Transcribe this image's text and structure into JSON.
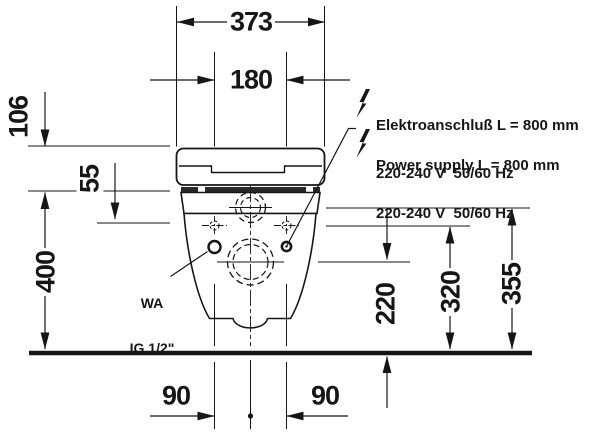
{
  "dimensions": {
    "d373": "373",
    "d180": "180",
    "d106": "106",
    "d55": "55",
    "d400": "400",
    "d220": "220",
    "d320": "320",
    "d355": "355",
    "d90_left": "90",
    "d90_right": "90"
  },
  "annotations": {
    "electrical_de_line1": "Elektroanschluß L = 800 mm",
    "electrical_de_line2": "220-240 V  50/60 Hz",
    "electrical_en_line1": "Power supply L = 800 mm",
    "electrical_en_line2": "220-240 V  50/60 Hz",
    "water_line1": "WA",
    "water_line2": "IG 1/2\""
  },
  "colors": {
    "ink": "#161616",
    "paper": "#ffffff"
  }
}
